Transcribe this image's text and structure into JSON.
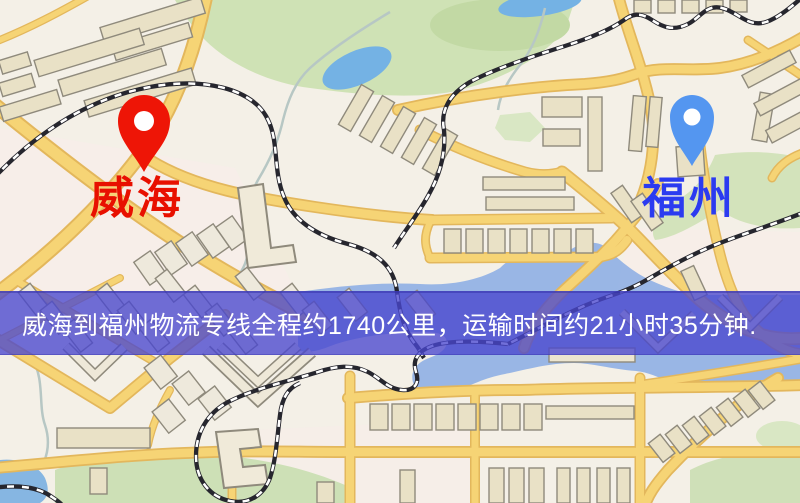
{
  "banner": {
    "text": "威海到福州物流专线全程约1740公里，运输时间约21小时35分钟.",
    "background_color": "#4946ce",
    "text_color": "#ffffff",
    "distance": "1740公里",
    "duration": "21小时35分钟"
  },
  "markers": {
    "origin": {
      "label": "威海",
      "pin_color": "#ee1506",
      "label_color": "#e81000"
    },
    "destination": {
      "label": "福州",
      "pin_color": "#5496f0",
      "label_color": "#2b3bf0"
    }
  },
  "map_colors": {
    "background": "#f4f0e7",
    "road_fill": "#f6d475",
    "road_casing": "#e3b75c",
    "park": "#cfe2b5",
    "water": "#7ab2e2",
    "building": "#e9e1c6",
    "railway": "#26262e"
  }
}
